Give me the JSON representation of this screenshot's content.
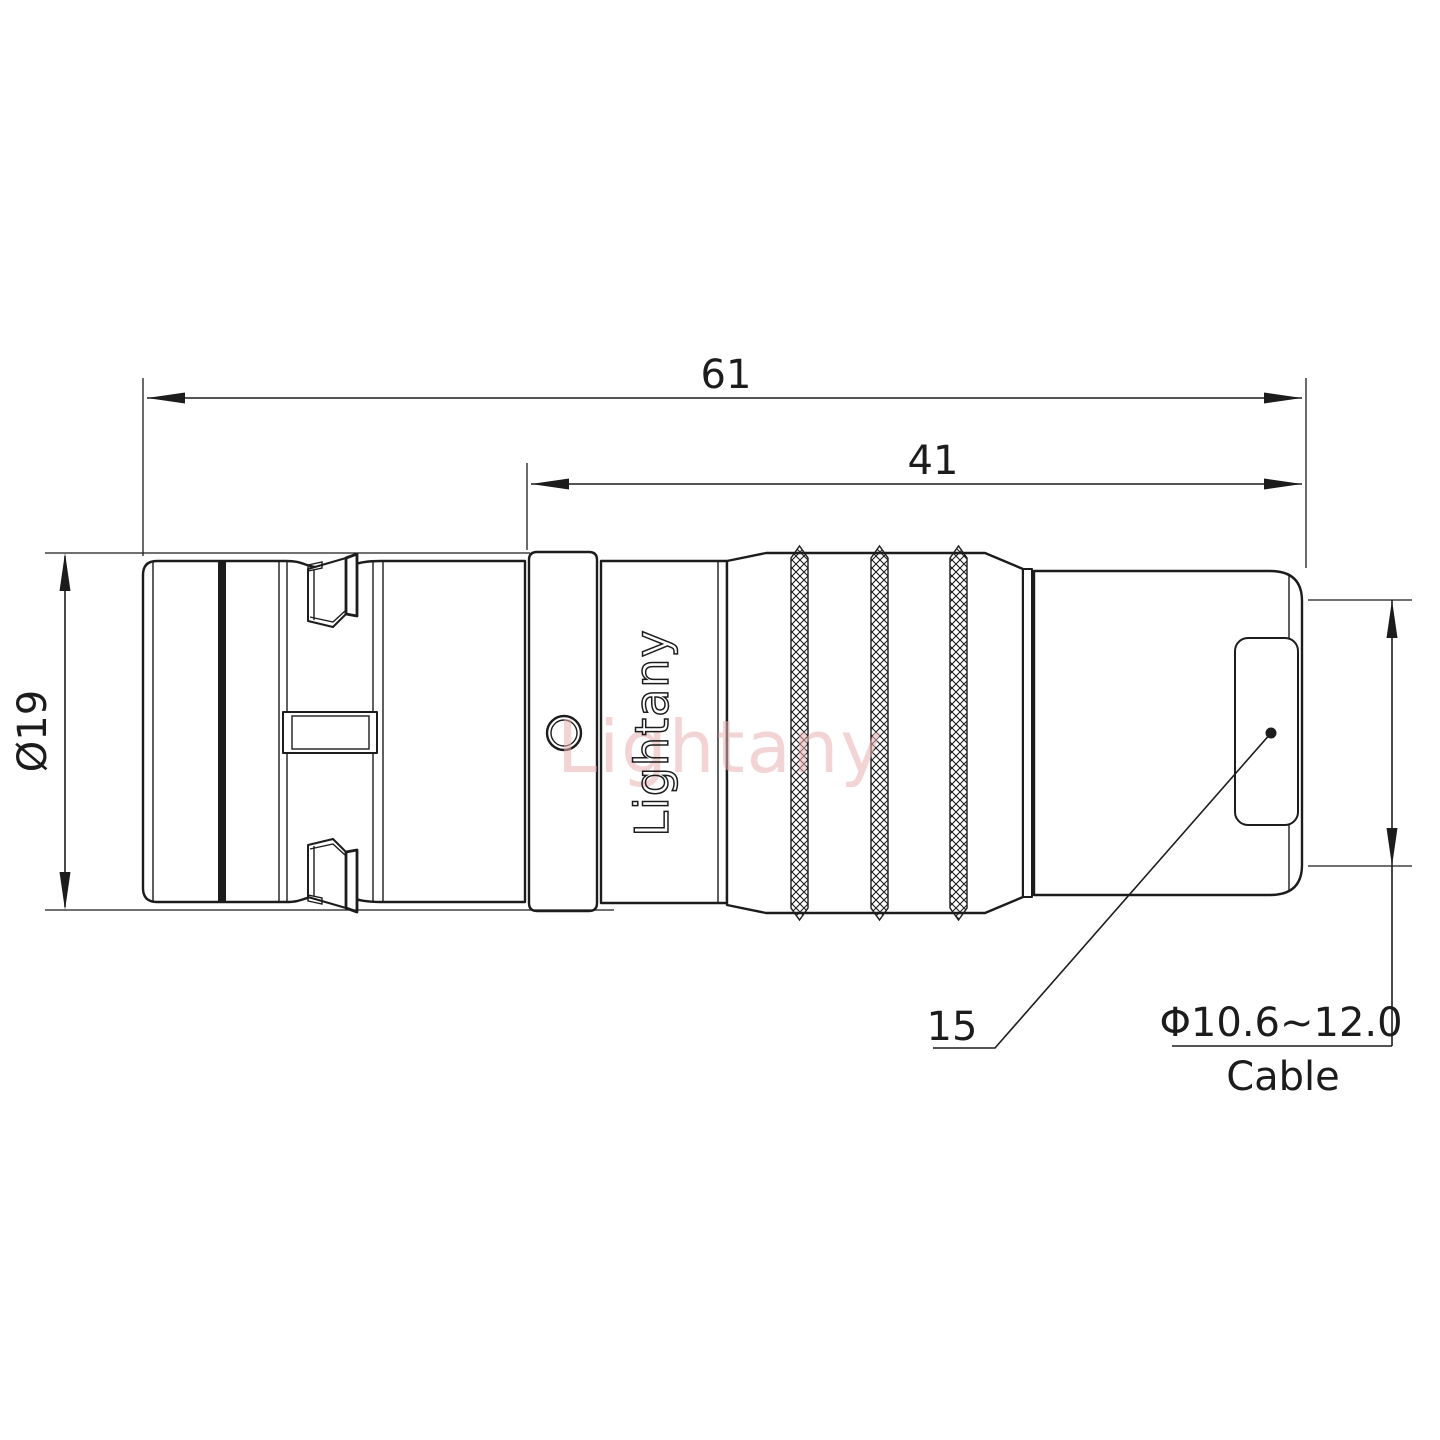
{
  "palette": {
    "background": "#ffffff",
    "line_color": "#1c1c1c",
    "watermark_color": "#e9b0b0"
  },
  "branding": {
    "body_label": "Lightany",
    "watermark": "Lightany"
  },
  "dimensions": {
    "overall_length": "61",
    "rear_section_length": "41",
    "body_diameter": "Ø19",
    "leader_ref": "15",
    "cable_range": "Φ10.6~12.0",
    "cable_label": "Cable"
  }
}
